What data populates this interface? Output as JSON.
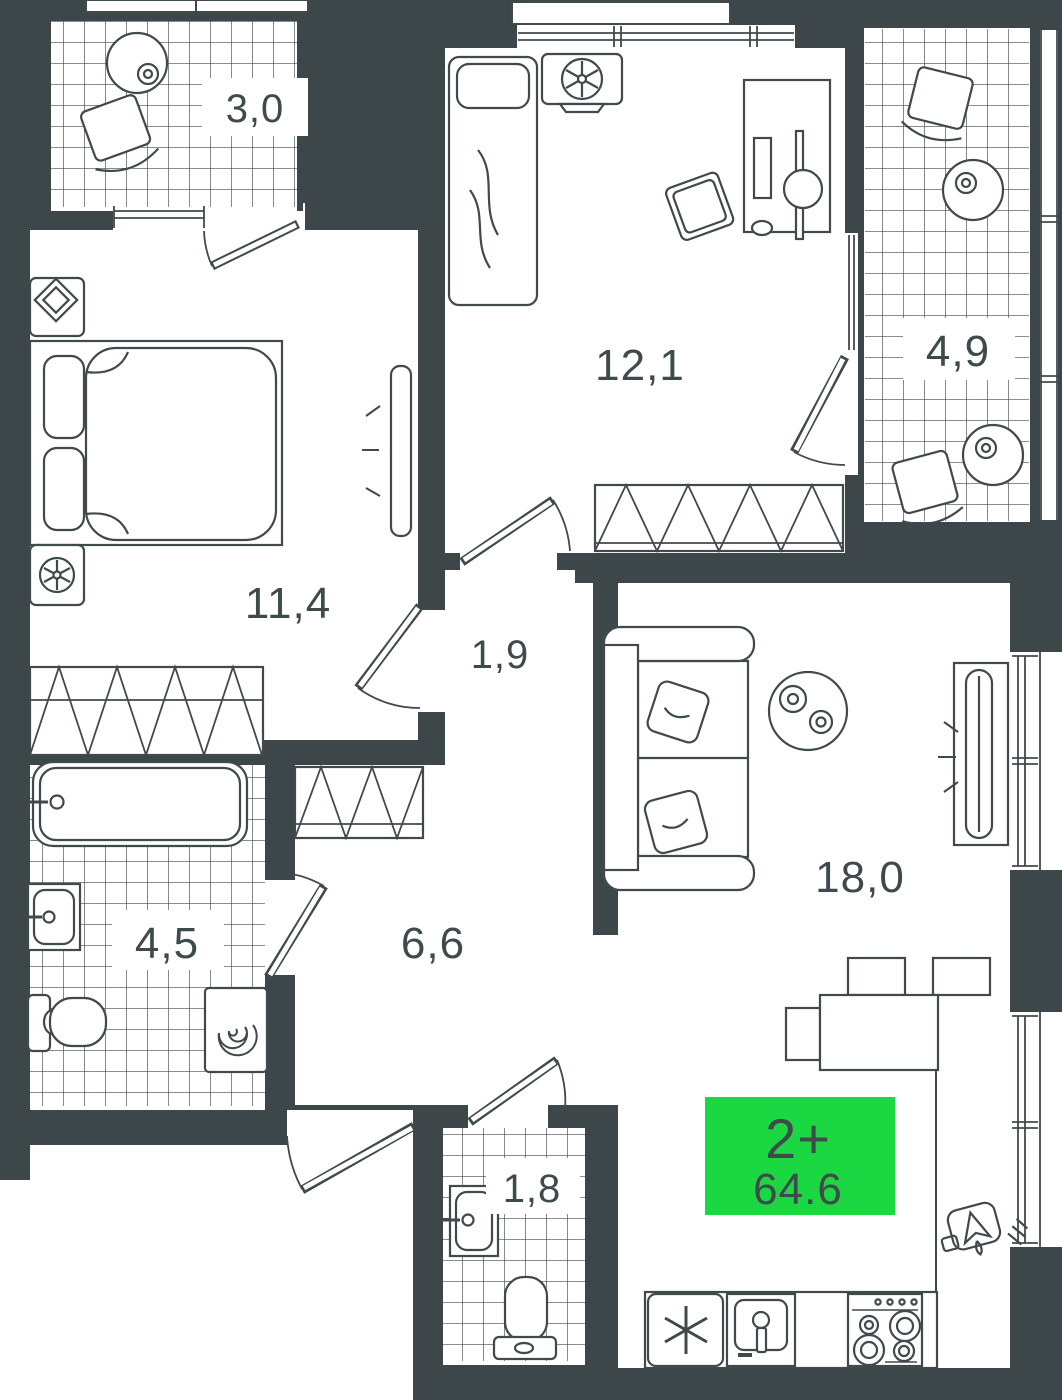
{
  "plan": {
    "unit_badge": {
      "type_label": "2+",
      "area_value": "64.6"
    },
    "rooms": {
      "balcony_small": {
        "area": "3,0"
      },
      "bedroom_second": {
        "area": "12,1"
      },
      "balcony_large": {
        "area": "4,9"
      },
      "bedroom_main": {
        "area": "11,4"
      },
      "hall_small": {
        "area": "1,9"
      },
      "living_kitchen": {
        "area": "18,0"
      },
      "bathroom": {
        "area": "4,5"
      },
      "hallway": {
        "area": "6,6"
      },
      "wc": {
        "area": "1,8"
      }
    },
    "colors": {
      "wall": "#3d4749",
      "floor": "#ffffff",
      "line": "#40494b",
      "accent_green": "#1bd742",
      "label_text": "#3e4a4c"
    }
  }
}
